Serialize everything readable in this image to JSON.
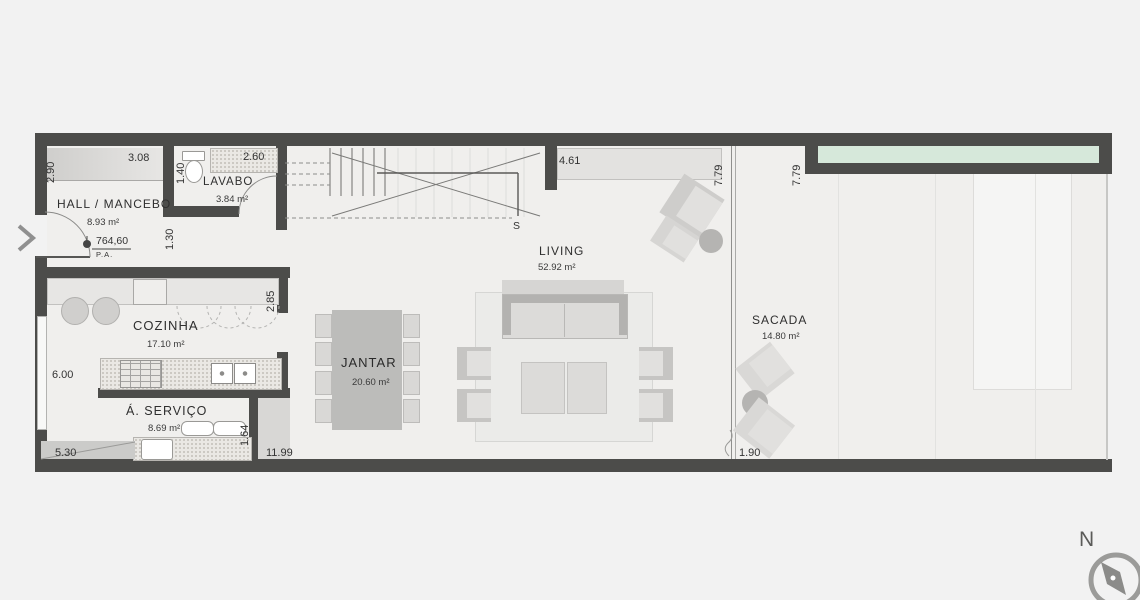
{
  "colors": {
    "wall": "#4c4c4a",
    "background": "#f2f2f2",
    "planter_green": "#d6e8da",
    "floor": "#f0efed"
  },
  "rooms": {
    "hall": {
      "name": "HALL / MANCEBO",
      "area": "8.93 m²"
    },
    "lavabo": {
      "name": "LAVABO",
      "area": "3.84 m²"
    },
    "cozinha": {
      "name": "COZINHA",
      "area": "17.10 m²"
    },
    "servico": {
      "name": "Á.  SERVIÇO",
      "area": "8.69 m²"
    },
    "jantar": {
      "name": "JANTAR",
      "area": "20.60 m²"
    },
    "living": {
      "name": "LIVING",
      "area": "52.92 m²"
    },
    "sacada": {
      "name": "SACADA",
      "area": "14.80 m²"
    }
  },
  "dimensions": {
    "hall_left": "2.90",
    "hall_top": "3.08",
    "lavabo_left": "1.40",
    "lavabo_top": "2.60",
    "hall_lower_left": "1.30",
    "living_top": "4.61",
    "living_glass": "7.79",
    "sacada_left": "7.79",
    "cozinha_right": "2.85",
    "cozinha_left": "6.00",
    "servico_right": "1.64",
    "bottom_left": "5.30",
    "bottom_center": "11.99",
    "sacada_bottom": "1.90"
  },
  "level_marker": {
    "value": "764,60",
    "reference": "P.A."
  },
  "stairs": {
    "direction_label": "S"
  },
  "compass": {
    "north_label": "N"
  }
}
